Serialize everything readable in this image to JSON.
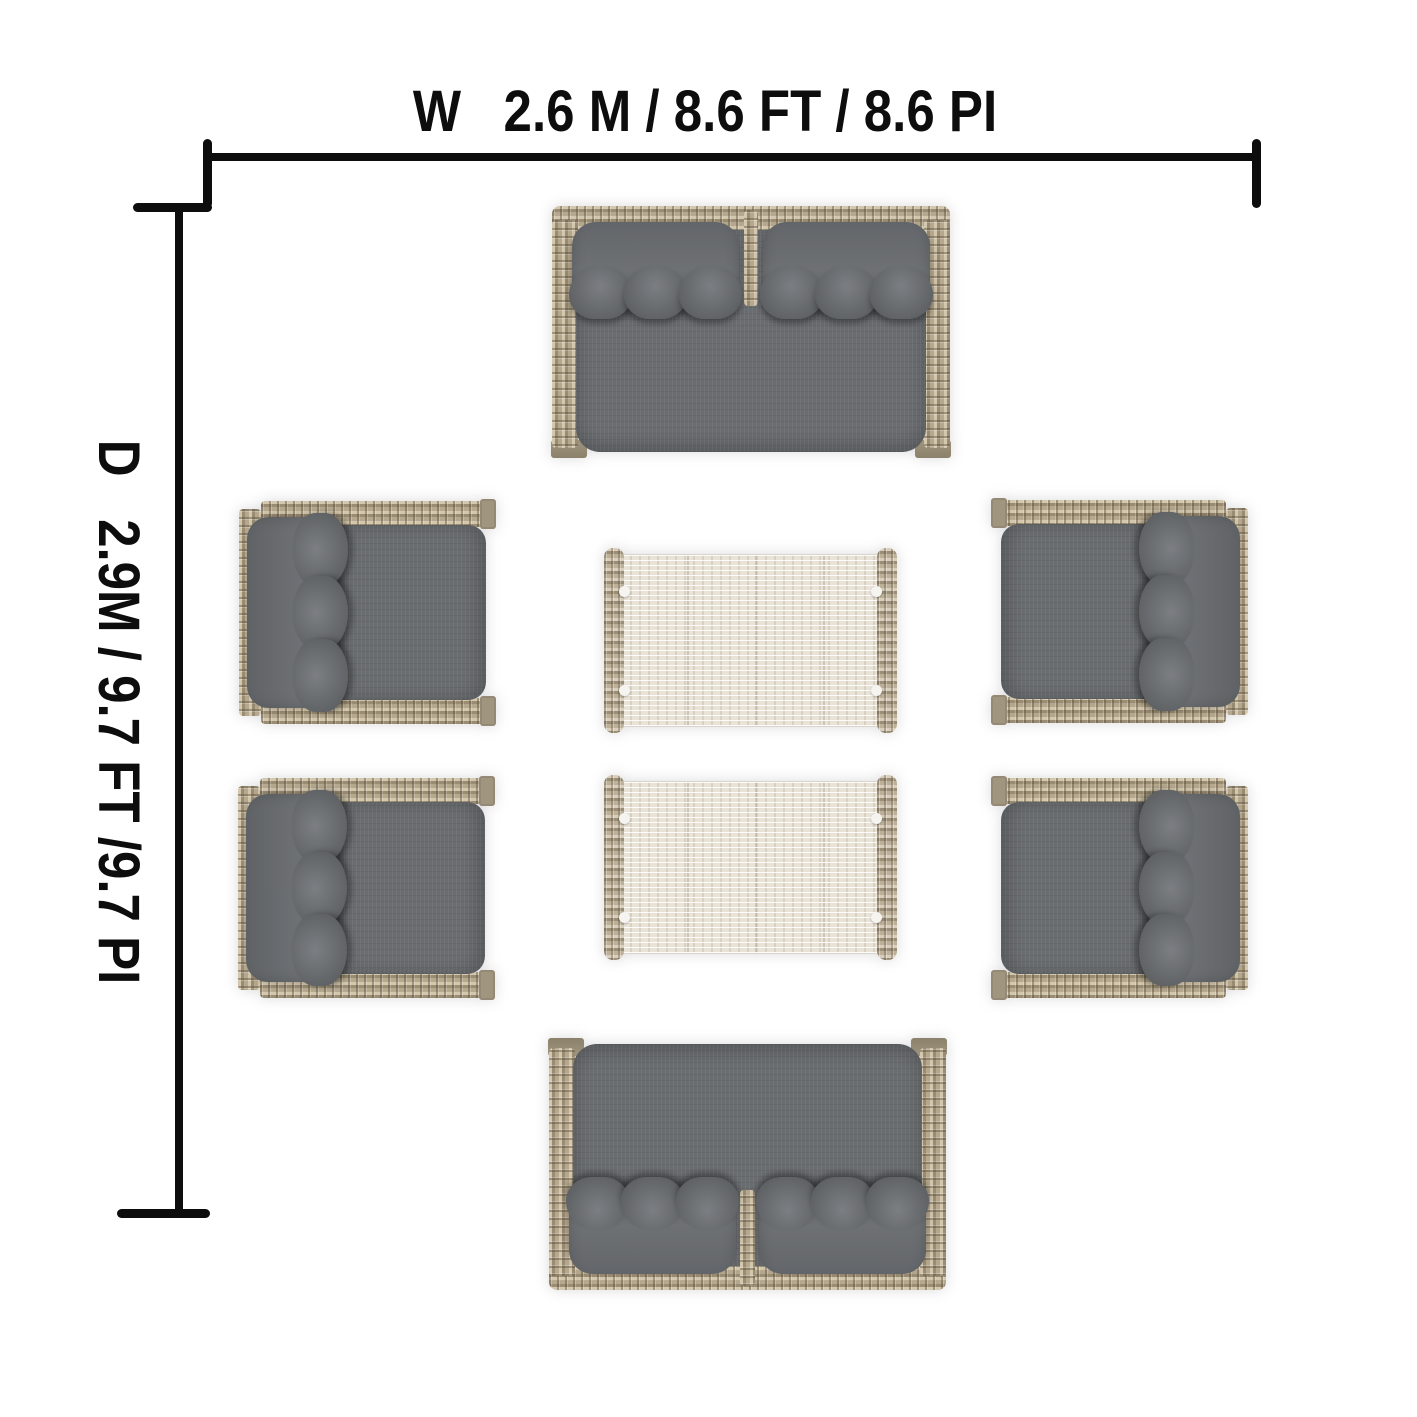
{
  "palette": {
    "background": "#ffffff",
    "line": "#0d0d0d",
    "wicker_light": "#d3c7ae",
    "wicker_mid": "#b5a88e",
    "wicker_dark": "#998c73",
    "wicker_foot": "#a0957e",
    "cushion": "#6a6d70",
    "cushion_dark": "#53565a",
    "cushion_light": "#7b7e82",
    "table_top": "#e8e2d7",
    "rail_mid": "#bcb098",
    "rail_dark": "#9a8e77",
    "rail_light": "#d8cebb",
    "dot": "#f6f4f0"
  },
  "dimensions": {
    "width_label": "W   2.6 M / 8.6 FT / 8.6 PI",
    "depth_label": "D   2.9M / 9.7 FT /9.7 PI",
    "width": {
      "meters": "2.6 M",
      "feet": "8.6 FT",
      "pieds": "8.6 PI"
    },
    "depth": {
      "meters": "2.9M",
      "feet": "9.7 FT",
      "pieds": "9.7 PI"
    }
  },
  "furniture": [
    {
      "type": "loveseat",
      "name": "loveseat-top",
      "x": 552,
      "y": 206,
      "w": 398,
      "h": 252,
      "flip": "none"
    },
    {
      "type": "armchair",
      "name": "armchair-left-front",
      "x": 239,
      "y": 501,
      "w": 257,
      "h": 223,
      "flip": "none"
    },
    {
      "type": "armchair",
      "name": "armchair-right-front",
      "x": 991,
      "y": 500,
      "w": 257,
      "h": 223,
      "flip": "x"
    },
    {
      "type": "table",
      "name": "coffee-table-front",
      "x": 604,
      "y": 548,
      "w": 293,
      "h": 185,
      "flip": "none"
    },
    {
      "type": "table",
      "name": "coffee-table-back",
      "x": 604,
      "y": 775,
      "w": 293,
      "h": 185,
      "flip": "none"
    },
    {
      "type": "armchair",
      "name": "armchair-left-back",
      "x": 238,
      "y": 778,
      "w": 257,
      "h": 220,
      "flip": "none"
    },
    {
      "type": "armchair",
      "name": "armchair-right-back",
      "x": 991,
      "y": 778,
      "w": 257,
      "h": 220,
      "flip": "x"
    },
    {
      "type": "loveseat",
      "name": "loveseat-bottom",
      "x": 549,
      "y": 1038,
      "w": 397,
      "h": 252,
      "flip": "y"
    }
  ]
}
